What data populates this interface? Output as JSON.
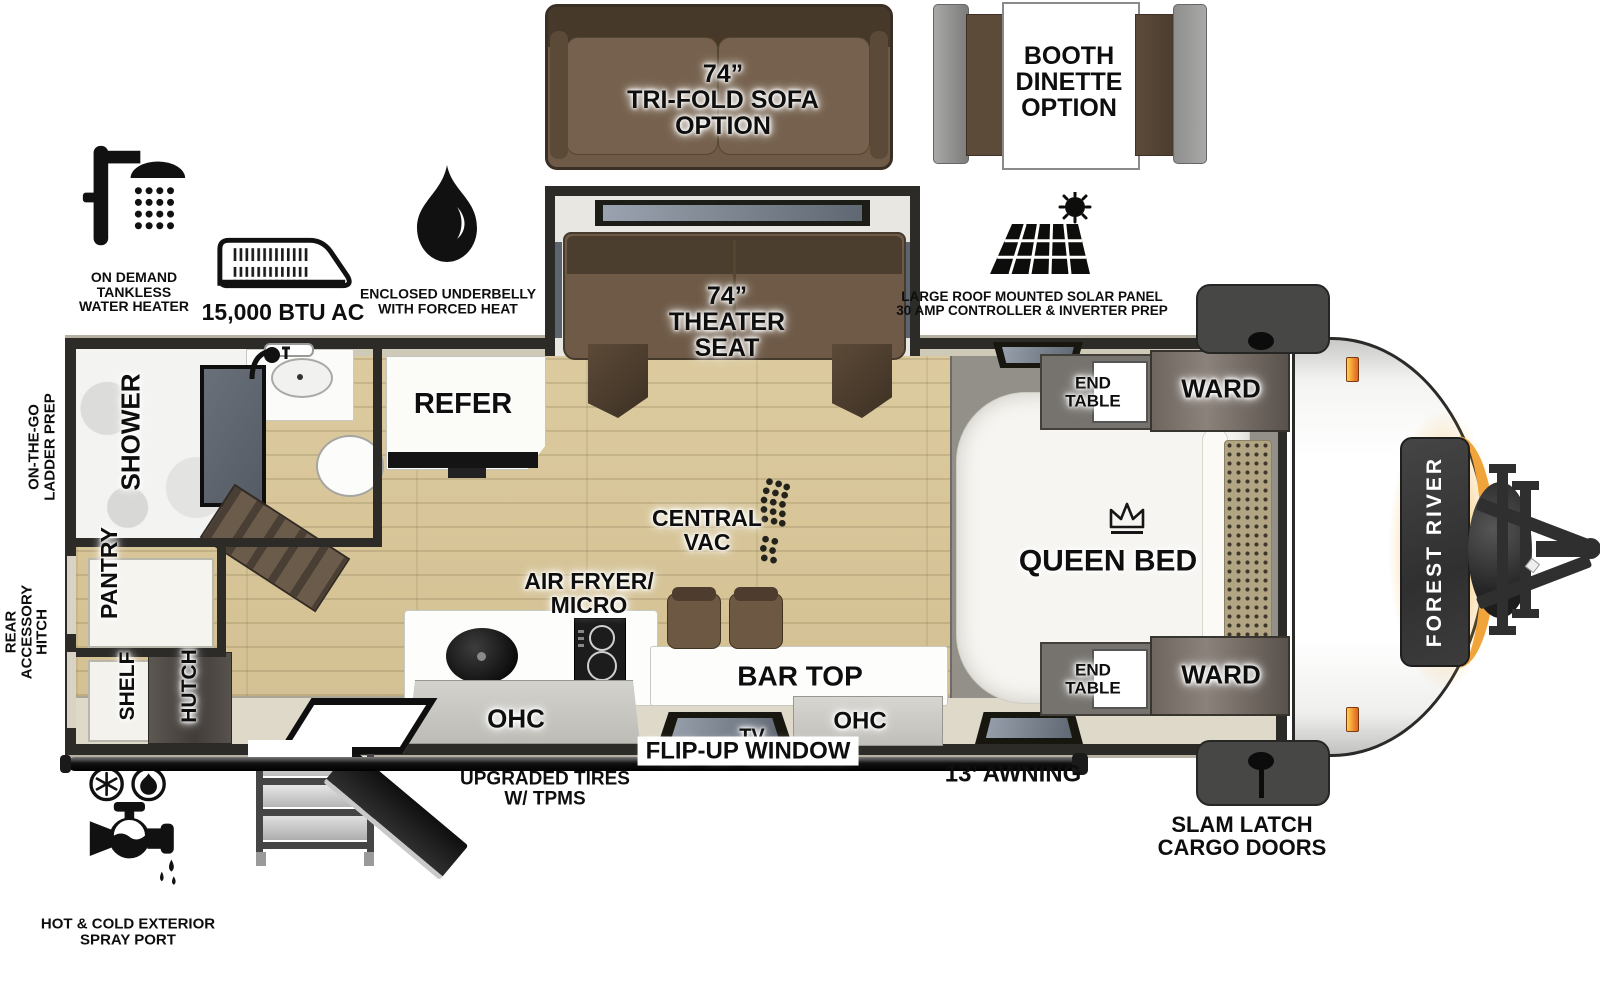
{
  "brand": {
    "name": "FOREST RIVER"
  },
  "colors": {
    "wall": "#2d2b28",
    "floor_wood": "#d7c59d",
    "slide_gray": "#93908a",
    "furniture_brown": "#6e5a47",
    "accent_orange": "#f0a43a",
    "cabinet_white": "#f4f4f1"
  },
  "options": {
    "sofa": {
      "line1": "74”",
      "line2": "TRI-FOLD SOFA",
      "line3": "OPTION"
    },
    "dinette": {
      "line1": "BOOTH",
      "line2": "DINETTE",
      "line3": "OPTION"
    }
  },
  "features": {
    "water_heater": {
      "line1": "ON DEMAND",
      "line2": "TANKLESS",
      "line3": "WATER HEATER"
    },
    "ac": {
      "label": "15,000 BTU AC"
    },
    "underbelly": {
      "line1": "ENCLOSED UNDERBELLY",
      "line2": "WITH FORCED HEAT"
    },
    "solar": {
      "line1": "LARGE ROOF MOUNTED SOLAR PANEL",
      "line2": "30 AMP CONTROLLER & INVERTER PREP"
    },
    "ladder": {
      "line1": "ON-THE-GO",
      "line2": "LADDER PREP"
    },
    "rear_hitch": {
      "line1": "REAR",
      "line2": "ACCESSORY",
      "line3": "HITCH"
    },
    "spray": {
      "line1": "HOT & COLD EXTERIOR",
      "line2": "SPRAY PORT"
    },
    "tires": {
      "line1": "UPGRADED TIRES",
      "line2": "W/ TPMS"
    },
    "flip_window": {
      "label": "FLIP-UP WINDOW"
    },
    "awning": {
      "label": "13’ AWNING"
    },
    "cargo": {
      "line1": "SLAM LATCH",
      "line2": "CARGO DOORS"
    }
  },
  "rooms": {
    "shower": "SHOWER",
    "pantry": "PANTRY",
    "shelf": "SHELF",
    "hutch": "HUTCH",
    "refer": "REFER",
    "theater": {
      "line1": "74”",
      "line2": "THEATER",
      "line3": "SEAT"
    },
    "central_vac": {
      "line1": "CENTRAL",
      "line2": "VAC"
    },
    "air_fryer": {
      "line1": "AIR FRYER/",
      "line2": "MICRO"
    },
    "bar_top": "BAR TOP",
    "ohc": "OHC",
    "tv": "TV",
    "queen_bed": "QUEEN BED",
    "end_table": {
      "line1": "END",
      "line2": "TABLE"
    },
    "ward": "WARD"
  }
}
